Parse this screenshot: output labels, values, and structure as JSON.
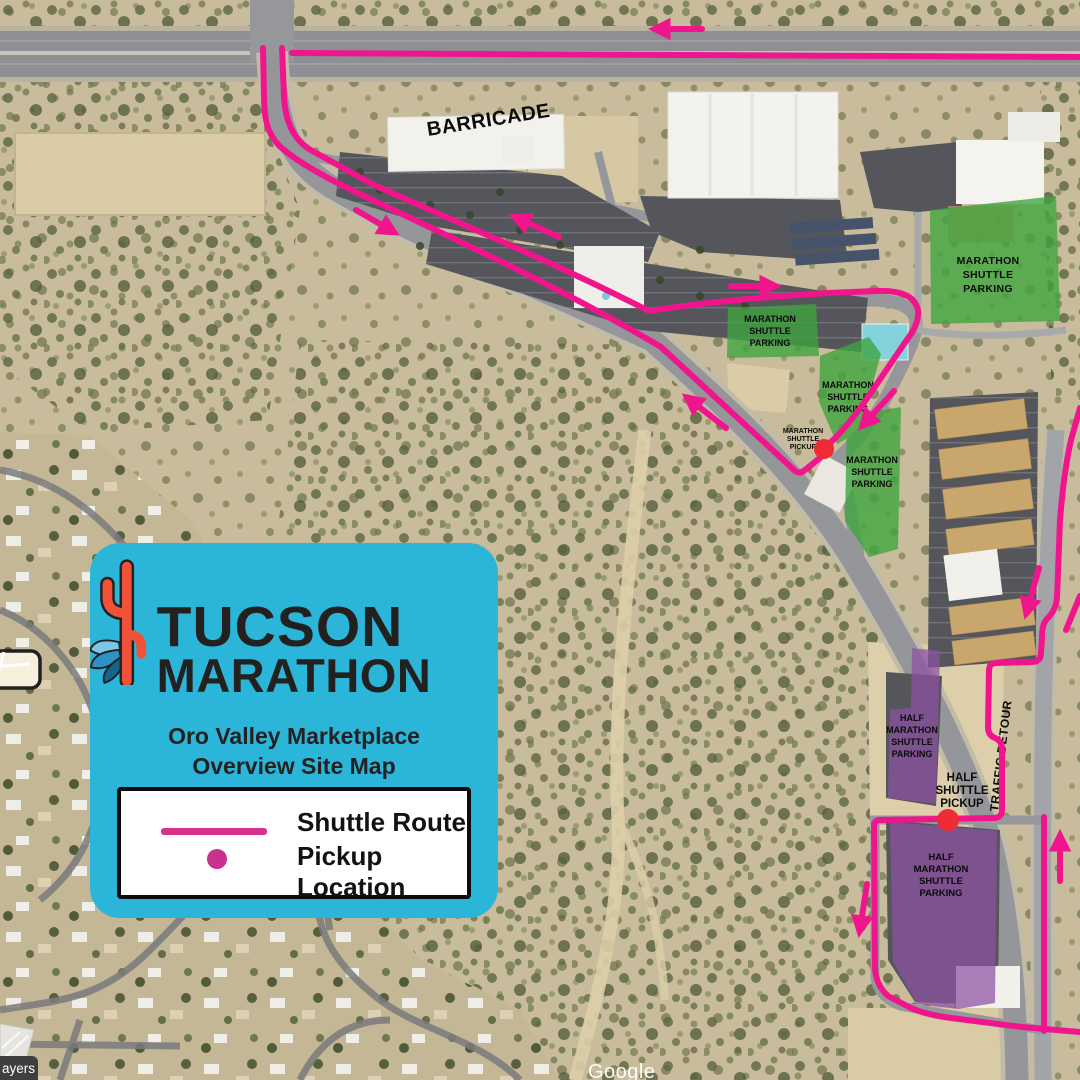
{
  "map": {
    "labels": {
      "barricade": "BARRICADE",
      "traffic_detour": "TRAFFIC DETOUR",
      "marathon_parking": [
        "MARATHON",
        "SHUTTLE",
        "PARKING"
      ],
      "half_parking": [
        "HALF",
        "MARATHON",
        "SHUTTLE",
        "PARKING"
      ],
      "marathon_pickup": [
        "MARATHON",
        "SHUTTLE",
        "PICKUP"
      ],
      "half_pickup": [
        "HALF",
        "SHUTTLE",
        "PICKUP"
      ]
    },
    "attribution": "Google",
    "layers_label": "ayers",
    "colors": {
      "route_pink": "#F0158C",
      "parking_green": "#3DA53E",
      "parking_purple": "#8E50A4",
      "pickup_red": "#EF2B35"
    }
  },
  "card": {
    "brand_top": "TUCSON",
    "brand_bottom": "MARATHON",
    "title_line1": "Oro Valley Marketplace",
    "title_line2": "Overview Site Map",
    "legend": {
      "route": "Shuttle Route",
      "pickup": "Pickup Location"
    },
    "colors": {
      "card_bg": "#2BB5D8",
      "legend_pink": "#D9308F"
    }
  }
}
